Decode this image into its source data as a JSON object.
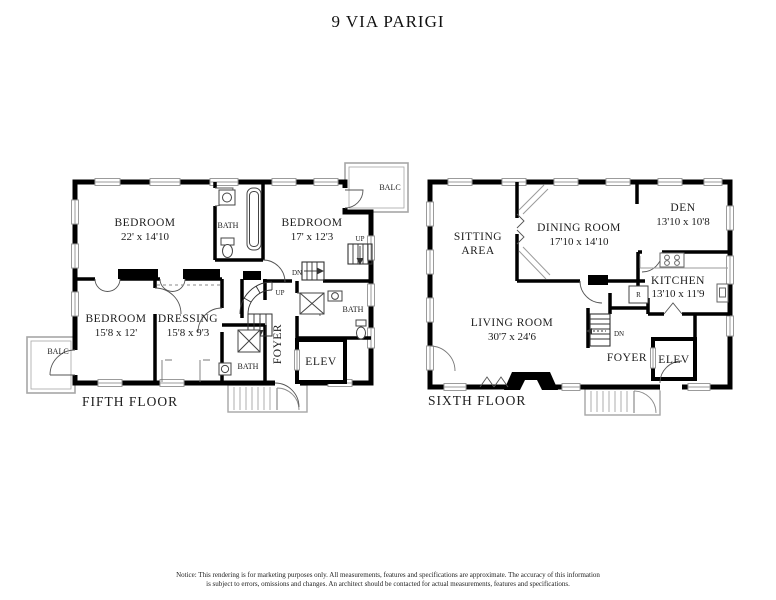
{
  "header": {
    "title": "9 VIA PARIGI"
  },
  "colors": {
    "wall": "#000000",
    "window_frame": "#9b9b9b",
    "outdoor_outline": "#a6a6a6"
  },
  "fifth": {
    "label": "FIFTH FLOOR",
    "bedroom1_name": "BEDROOM",
    "bedroom1_dims": "22' x 14'10",
    "bedroom2_name": "BEDROOM",
    "bedroom2_dims": "17' x 12'3",
    "bedroom3_name": "BEDROOM",
    "bedroom3_dims": "15'8 x 12'",
    "dressing_name": "DRESSING",
    "dressing_dims": "15'8 x 9'3",
    "bath_upper": "BATH",
    "bath_lower": "BATH",
    "bath_right": "BATH",
    "foyer": "FOYER",
    "elev": "ELEV",
    "balc_top": "BALC",
    "balc_bottom": "BALC",
    "up_top": "UP",
    "up_foyer": "UP",
    "dn": "DN"
  },
  "sixth": {
    "label": "SIXTH FLOOR",
    "sitting_line1": "SITTING",
    "sitting_line2": "AREA",
    "dining_name": "DINING ROOM",
    "dining_dims": "17'10 x 14'10",
    "den_name": "DEN",
    "den_dims": "13'10 x 10'8",
    "kitchen_name": "KITCHEN",
    "kitchen_dims": "13'10 x 11'9",
    "living_name": "LIVING ROOM",
    "living_dims": "30'7 x 24'6",
    "foyer": "FOYER",
    "elev": "ELEV",
    "dn": "DN",
    "fridge": "R"
  },
  "footer": {
    "notice_line1": "Notice:  This rendering is for marketing purposes only. All measurements, features and specifications are approximate. The accuracy of this information",
    "notice_line2": "is subject to errors, omissions and changes. An architect should be contacted for actual measurements, features and specifications."
  }
}
